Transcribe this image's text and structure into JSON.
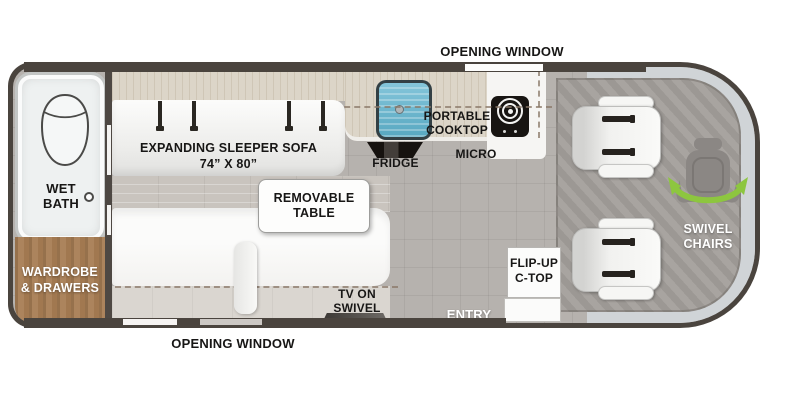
{
  "floorplan": {
    "exterior": {
      "opening_window_top": "OPENING WINDOW",
      "opening_window_bottom": "OPENING WINDOW"
    },
    "bath": {
      "line1": "WET",
      "line2": "BATH"
    },
    "storage": {
      "line1": "WARDROBE",
      "line2": "& DRAWERS"
    },
    "lounge": {
      "sofa_line1": "EXPANDING SLEEPER SOFA",
      "sofa_line2": "74” X 80”",
      "table_line1": "REMOVABLE",
      "table_line2": "TABLE",
      "tv_line1": "TV ON",
      "tv_line2": "SWIVEL"
    },
    "galley": {
      "cooktop_line1": "PORTABLE",
      "cooktop_line2": "COOKTOP",
      "fridge": "FRIDGE",
      "micro": "MICRO",
      "flipup_line1": "FLIP-UP",
      "flipup_line2": "C-TOP",
      "entry": "ENTRY"
    },
    "cab": {
      "swivel_line1": "SWIVEL",
      "swivel_line2": "CHAIRS"
    },
    "icons": {
      "toilet": "toilet-icon",
      "sink": "sink-icon",
      "burner": "cooktop-burner-icon",
      "fridge_vent": "fridge-icon",
      "seat_belt": "seat-belt-icon",
      "swivel_seat": "swivel-seat-icon",
      "tv": "tv-icon"
    },
    "colors": {
      "wall": "#4a443e",
      "floor_tile": "#b6b2ae",
      "cab_floor": "#a39f9b",
      "windshield": "#d0d4d7",
      "counter_wood": "#dcd5c8",
      "wardrobe_wood": "#a9815a",
      "sink_blue": "#5fb0c9",
      "swivel_green": "#8dc63f"
    }
  }
}
